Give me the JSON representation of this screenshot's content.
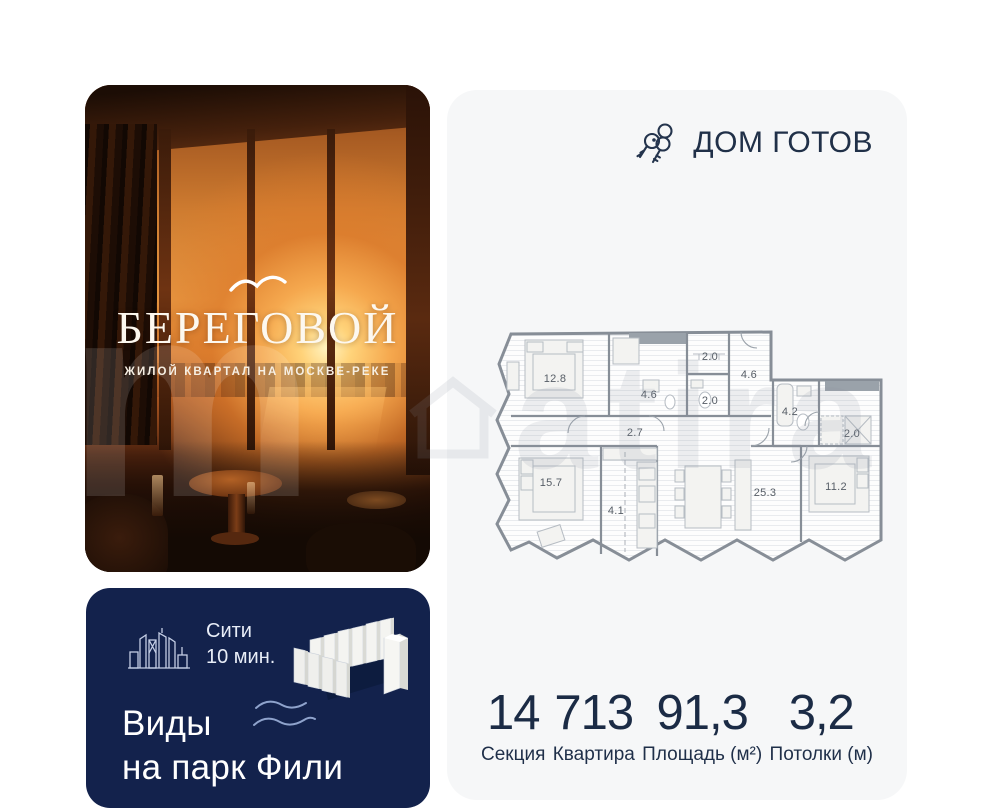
{
  "photo_card": {
    "brand_title": "БЕРЕГОВОЙ",
    "brand_subtitle": "ЖИЛОЙ КВАРТАЛ НА МОСКВЕ-РЕКЕ"
  },
  "info_card": {
    "bg_color": "#13224c",
    "citi_line1": "Сити",
    "citi_line2": "10 мин.",
    "views_line1": "Виды",
    "views_line2": "на парк Фили"
  },
  "right_card": {
    "bg_color": "#f6f7f8",
    "header": {
      "label": "ДОМ ГОТОВ",
      "color": "#203048"
    },
    "floorplan": {
      "rooms": [
        {
          "label": "12.8",
          "x": 66,
          "y": 64
        },
        {
          "label": "4.6",
          "x": 160,
          "y": 80
        },
        {
          "label": "2.0",
          "x": 221,
          "y": 42
        },
        {
          "label": "2.0",
          "x": 221,
          "y": 86
        },
        {
          "label": "4.6",
          "x": 260,
          "y": 60
        },
        {
          "label": "2.7",
          "x": 146,
          "y": 118
        },
        {
          "label": "4.2",
          "x": 301,
          "y": 97
        },
        {
          "label": "2.0",
          "x": 363,
          "y": 119
        },
        {
          "label": "15.7",
          "x": 62,
          "y": 168
        },
        {
          "label": "4.1",
          "x": 127,
          "y": 196
        },
        {
          "label": "25.3",
          "x": 276,
          "y": 178
        },
        {
          "label": "11.2",
          "x": 347,
          "y": 172
        }
      ]
    },
    "stats": [
      {
        "value": "14",
        "label": "Секция"
      },
      {
        "value": "713",
        "label": "Квартира"
      },
      {
        "value": "91,3",
        "label": "Площадь (м²)"
      },
      {
        "value": "3,2",
        "label": "Потолки (м)"
      }
    ]
  },
  "watermark": {
    "text": "atira"
  }
}
